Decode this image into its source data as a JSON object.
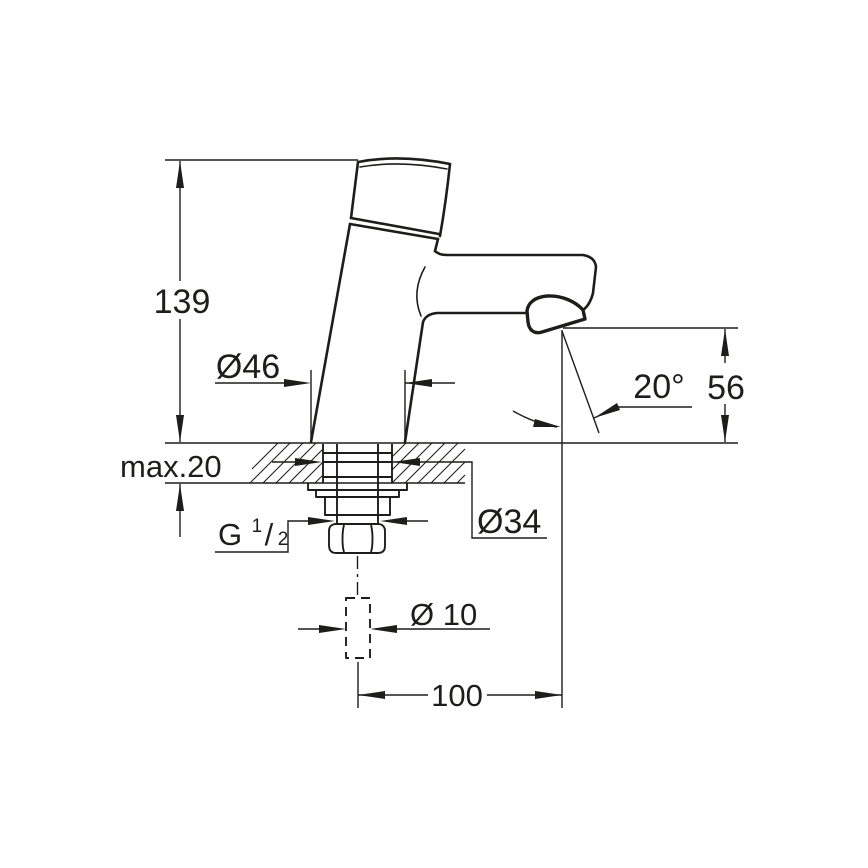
{
  "drawing": {
    "type": "faucet-installation-dimension-drawing",
    "colors": {
      "line": "#1d1d1b",
      "background": "#ffffff"
    },
    "labels": {
      "total_height": "139",
      "base_diameter": "Ø46",
      "counter_thickness": "max.20",
      "thread_g": "G",
      "thread_numerator": "1",
      "thread_slash": "/",
      "thread_denominator": "2",
      "shank_diameter": "Ø34",
      "supply_tube_diameter": "Ø 10",
      "spout_reach": "100",
      "spout_outlet_height": "56",
      "spray_angle": "20°"
    }
  }
}
